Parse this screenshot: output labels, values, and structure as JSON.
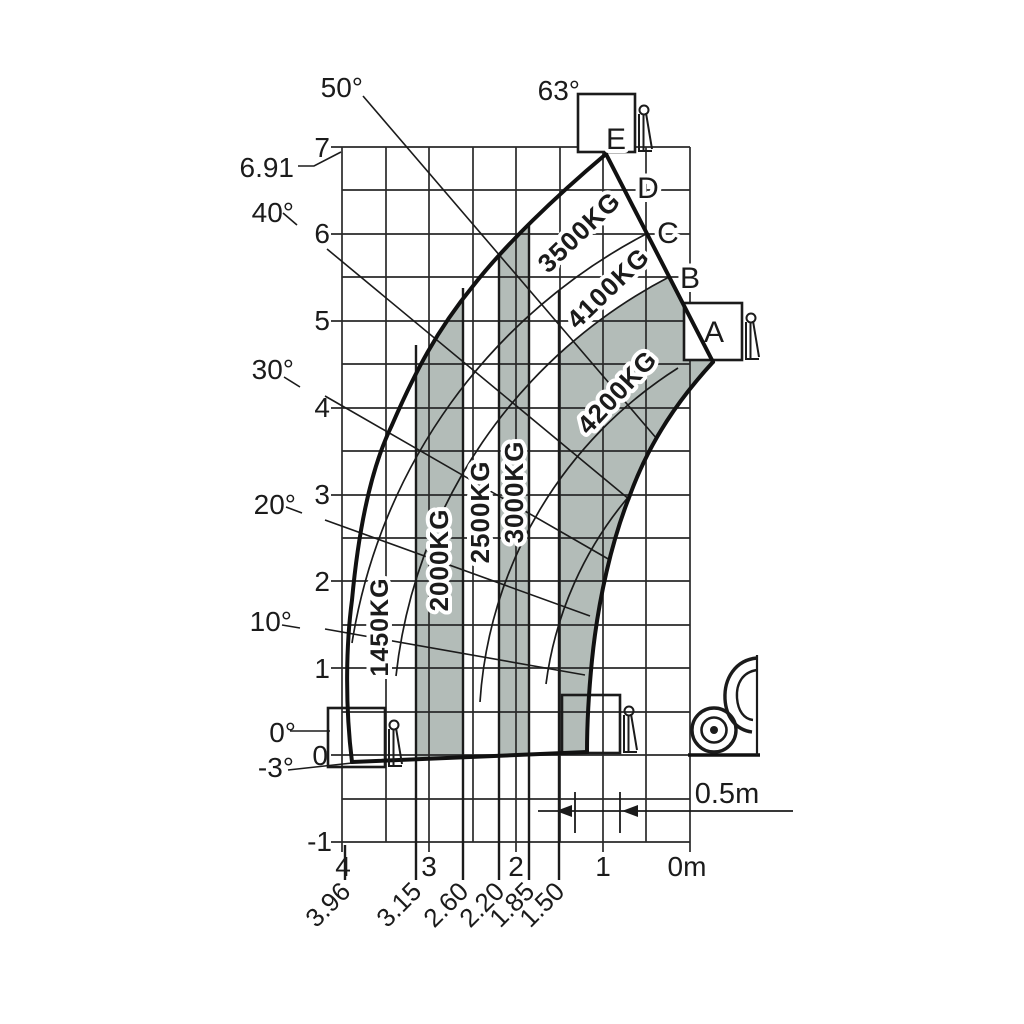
{
  "colors": {
    "band_fill": "#b3bcb8",
    "ink": "#1b1b1b",
    "background": "#ffffff"
  },
  "axes": {
    "height_ticks": [
      "7",
      "6",
      "5",
      "4",
      "3",
      "2",
      "1",
      "0",
      "-1"
    ],
    "reach_ticks": [
      "4",
      "3",
      "2",
      "1",
      "0m"
    ],
    "reach_marks": [
      "3.96",
      "3.15",
      "2.60",
      "2.20",
      "1.85",
      "1.50"
    ],
    "max_height": "6.91"
  },
  "angles": {
    "a50": "50°",
    "a63": "63°",
    "a40": "40°",
    "a30": "30°",
    "a20": "20°",
    "a10": "10°",
    "a0": "0°",
    "am3": "-3°"
  },
  "capacities": {
    "c1450": "1450KG",
    "c2000": "2000KG",
    "c2500": "2500KG",
    "c3000": "3000KG",
    "c3500": "3500KG",
    "c4100": "4100KG",
    "c4200": "4200KG"
  },
  "stages": {
    "A": "A",
    "B": "B",
    "C": "C",
    "D": "D",
    "E": "E"
  },
  "dimension": {
    "offset": "0.5m"
  },
  "chart_data": {
    "type": "area",
    "title": "Telehandler load capacity chart",
    "xlabel": "Reach (m)",
    "ylabel": "Lift height (m)",
    "x_range_m": [
      0,
      4
    ],
    "x_axis_reversed": true,
    "y_range_m": [
      -1,
      7
    ],
    "grid": "0.5 m squares, grid on",
    "max_lift_height_m": 6.91,
    "boom_angles_deg": [
      -3,
      0,
      10,
      20,
      30,
      40,
      50,
      63
    ],
    "extension_stages": [
      "A",
      "B",
      "C",
      "D",
      "E"
    ],
    "reach_boundaries_m": [
      3.96,
      3.15,
      2.6,
      2.2,
      1.85,
      1.5
    ],
    "capacity_zones": [
      {
        "capacity_kg": 1450,
        "reach_m": [
          3.15,
          3.96
        ],
        "shaded": false
      },
      {
        "capacity_kg": 2000,
        "reach_m": [
          2.6,
          3.15
        ],
        "shaded": true
      },
      {
        "capacity_kg": 2500,
        "reach_m": [
          2.2,
          2.6
        ],
        "shaded": false
      },
      {
        "capacity_kg": 3000,
        "reach_m": [
          1.85,
          2.2
        ],
        "shaded": true
      },
      {
        "capacity_kg": 3500,
        "region": "upper envelope between stage arcs D-E",
        "shaded": false
      },
      {
        "capacity_kg": 4100,
        "region": "upper envelope between stage arcs B-C",
        "shaded": false
      },
      {
        "capacity_kg": 4200,
        "reach_m": [
          0,
          1.5
        ],
        "shaded": true
      }
    ],
    "front_offset_m": 0.5
  }
}
